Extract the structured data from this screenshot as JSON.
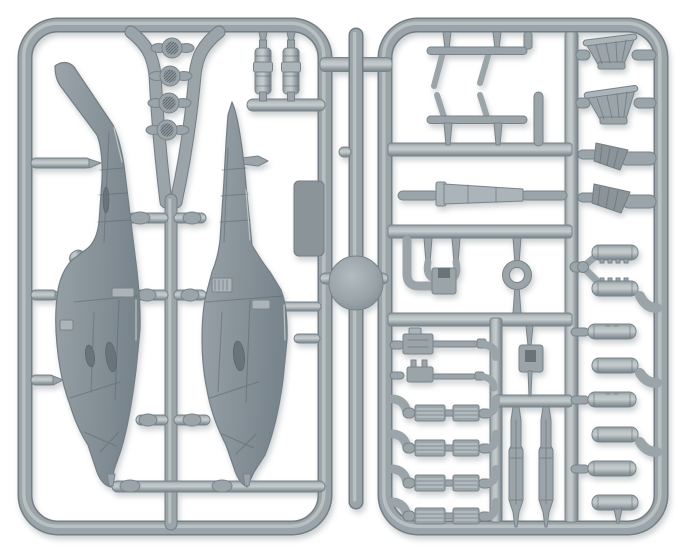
{
  "scene": {
    "type": "product-photograph",
    "description": "Grey injection-moulded plastic model kit sprue for a miniature attack helicopter: two fuselage halves, four rotor hub discs, landing skids, exhaust stacks, intake scoops, rocket pod tubes, chin guns, missile rails and missiles, all attached to two rectangular runner frames joined by a central runner with a round moulding disc",
    "background": "#ffffff"
  },
  "colors": {
    "bg": "#ffffff",
    "plastic": "#9aa4a9",
    "plastic-mid": "#abb4b8",
    "plastic-light": "#c6cccd",
    "plastic-dark": "#737e84",
    "plastic-stroke": "#79848a",
    "fuselage": "#8b959c",
    "fuselage-dark": "#57626a",
    "panel-dark": "#8b9499",
    "window": "#68737a"
  },
  "sprue": {
    "frames": [
      {
        "label": "left runner frame"
      },
      {
        "label": "right runner frame"
      }
    ],
    "parts": [
      {
        "label": "helicopter fuselage half (left)",
        "count": 1
      },
      {
        "label": "helicopter fuselage half (right)",
        "count": 1
      },
      {
        "label": "rotor hub disc",
        "count": 4
      },
      {
        "label": "engine exhaust stack",
        "count": 2
      },
      {
        "label": "flat access panel",
        "count": 1
      },
      {
        "label": "landing skid",
        "count": 2
      },
      {
        "label": "tail boom section",
        "count": 1
      },
      {
        "label": "exhaust funnel",
        "count": 2
      },
      {
        "label": "intake scoop",
        "count": 2
      },
      {
        "label": "rocket pod tube",
        "count": 8
      },
      {
        "label": "gun sight yoke",
        "count": 1
      },
      {
        "label": "sight ring",
        "count": 1
      },
      {
        "label": "chin gun",
        "count": 2
      },
      {
        "label": "missile rail",
        "count": 4
      },
      {
        "label": "missile",
        "count": 2
      },
      {
        "label": "sensor bracket",
        "count": 1
      },
      {
        "label": "central moulding disc",
        "count": 1
      }
    ]
  }
}
